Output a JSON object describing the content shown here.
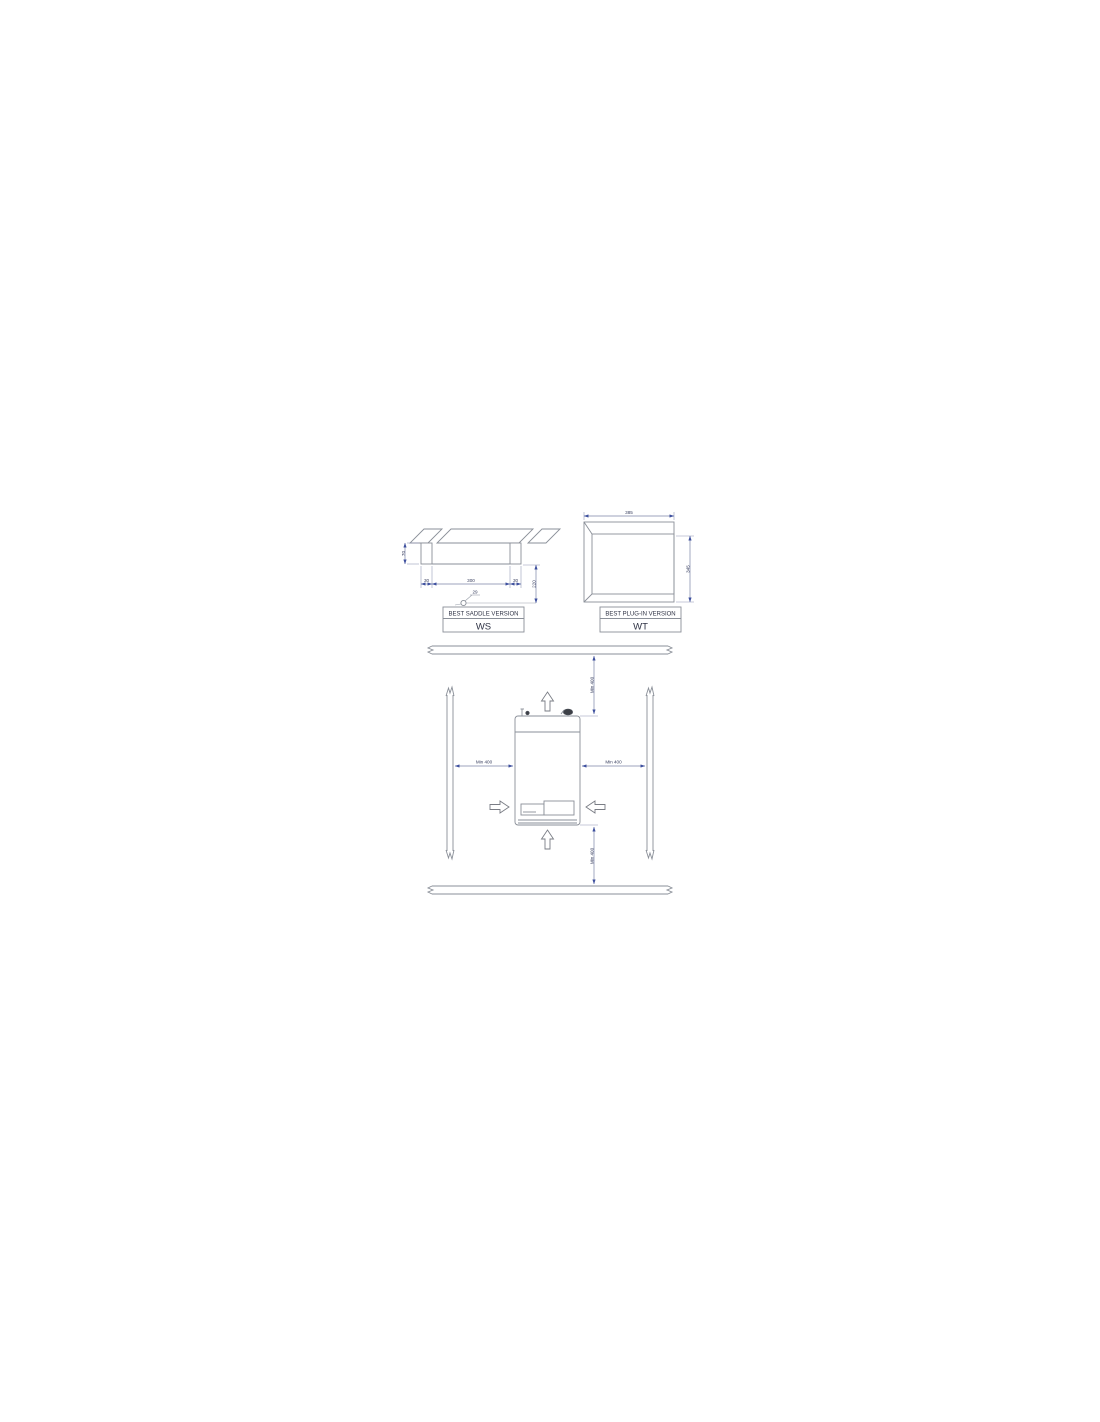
{
  "ws": {
    "title": "BEST SADDLE VERSION",
    "code": "WS",
    "dims": {
      "left_height": "70",
      "slot_left": "30",
      "span": "300",
      "slot_right": "30",
      "depth": "220",
      "leader": "29"
    }
  },
  "wt": {
    "title": "BEST PLUG-IN VERSION",
    "code": "WT",
    "dims": {
      "width": "385",
      "height": "345"
    }
  },
  "clearance": {
    "top": "Min 400",
    "left": "Min 400",
    "right": "Min 400",
    "bottom": "Min 400"
  },
  "colors": {
    "object_line": "#8a8f98",
    "dimension_line": "#7b84a8",
    "arrow_fill": "#3d4f9e",
    "text": "#3a4060"
  }
}
